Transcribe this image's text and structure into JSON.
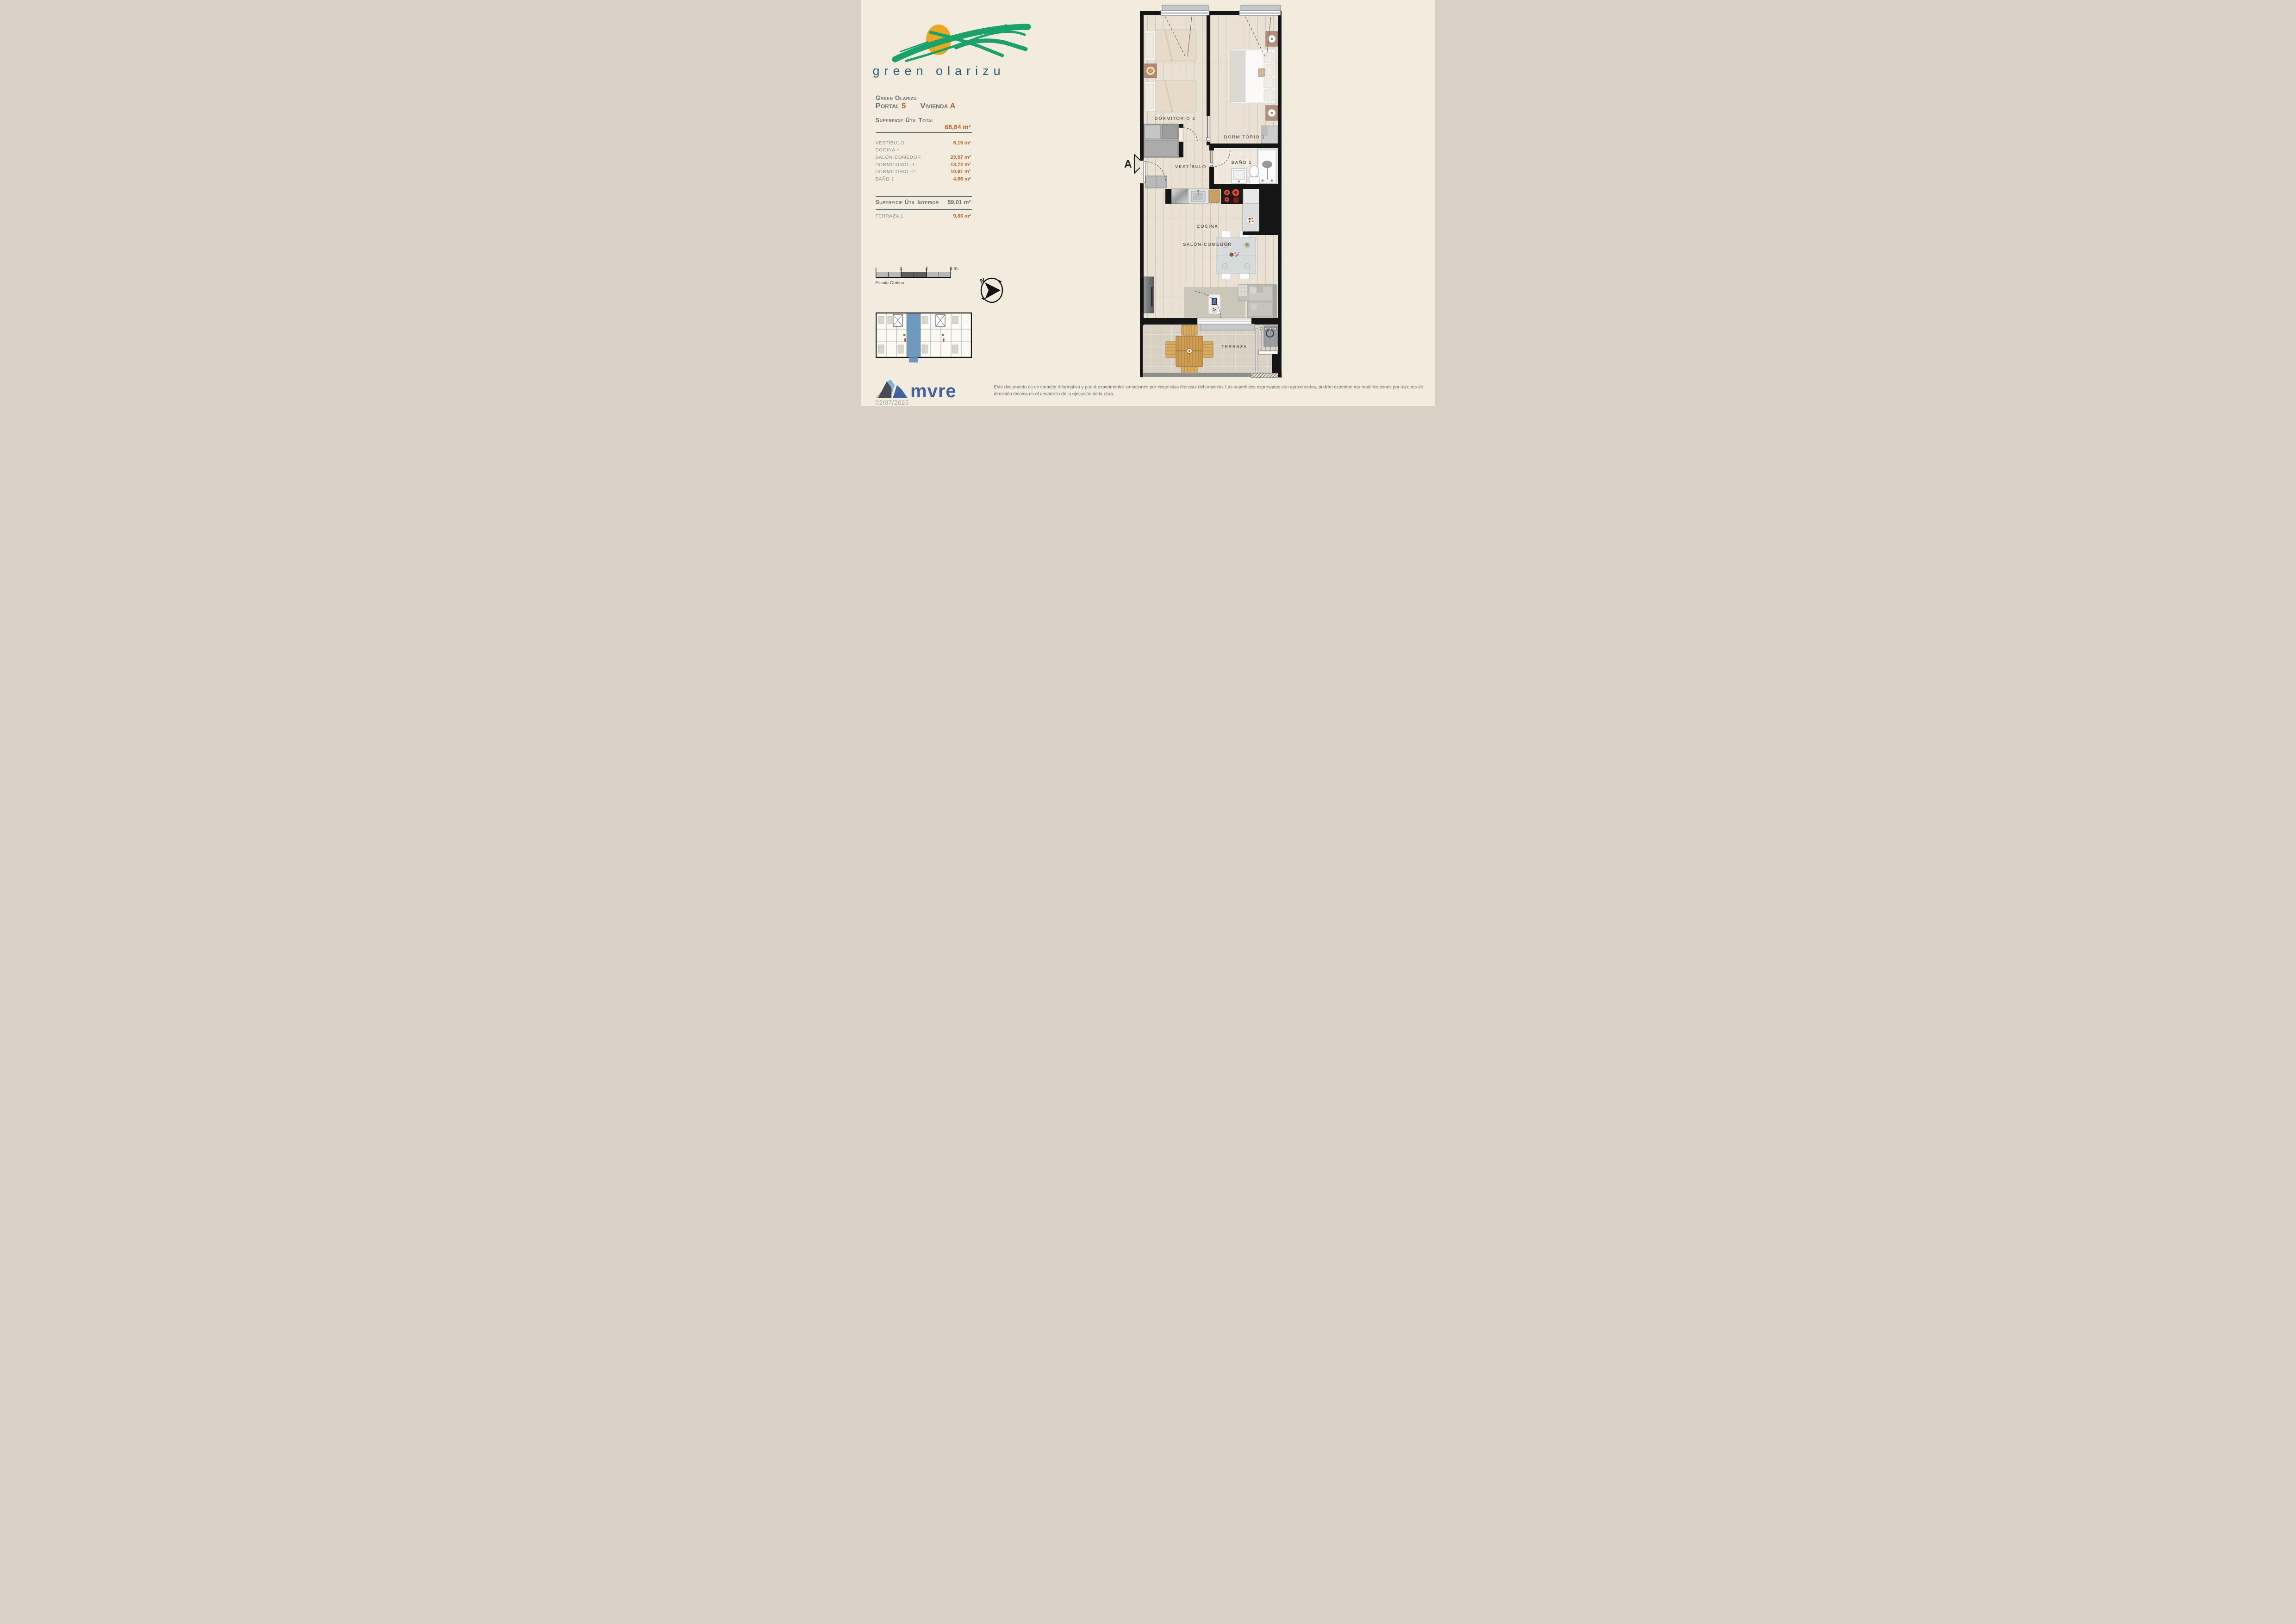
{
  "document": {
    "date": "02/07/2025",
    "disclaimer": "Este documento es de caracter informativo y podrá experimentar variaciones por exigencias técnicas del proyecto. Las superficies expresadas son aproximadas, podrán experimentar modificaciones por razones de dirección técnica en el desarrollo de la ejecución de la obra."
  },
  "brand": {
    "logo_text": "green olarizu",
    "developer_logo_text": "mvre"
  },
  "header": {
    "project_name": "Green Olarizu",
    "portal_label": "Portal",
    "portal_number": "5",
    "vivienda_label": "Vivienda",
    "vivienda_letter": "A"
  },
  "surfaces": {
    "total_label": "Superficie Útil Total",
    "total_value": "68,84 m²",
    "rooms": [
      {
        "label": "VESTÍBULO",
        "value": "6,15 m²"
      },
      {
        "label": "COCINA +",
        "value": ""
      },
      {
        "label": "SALON-COMEDOR",
        "value": "23,57 m²"
      },
      {
        "label": "DORMITORIO -1-",
        "value": "13,72 m²"
      },
      {
        "label": "DORMITORIO -2-",
        "value": "10,91 m²"
      },
      {
        "label": "BAÑO 1",
        "value": "4,66 m²"
      }
    ],
    "interior_label": "Superficie Útil Interior",
    "interior_value": "59,01 m²",
    "terraza_label": "TERRAZA 1",
    "terraza_value": "9,83 m²"
  },
  "scale_bar": {
    "caption": "Escala Gráfica",
    "ticks": [
      "1",
      "2",
      "3 m."
    ]
  },
  "compass": {
    "north": "N"
  },
  "plan": {
    "section_marker": "A",
    "labels": {
      "dormitorio2": "DORMITORIO 2",
      "dormitorio1": "DORMITORIO 1",
      "vestibulo": "VESTÍBULO",
      "bano": "BAÑO 1",
      "cocina": "COCINA",
      "salon": "SALÓN-COMEDOR",
      "terraza": "TERRAZA"
    }
  },
  "colors": {
    "accent_orange": "#c2662c",
    "brand_green": "#19a36b",
    "brand_teal": "#2a607c",
    "mvre_blue": "#44639c",
    "highlight_blue": "#5b8bb5",
    "background": "#f2ecdf"
  }
}
